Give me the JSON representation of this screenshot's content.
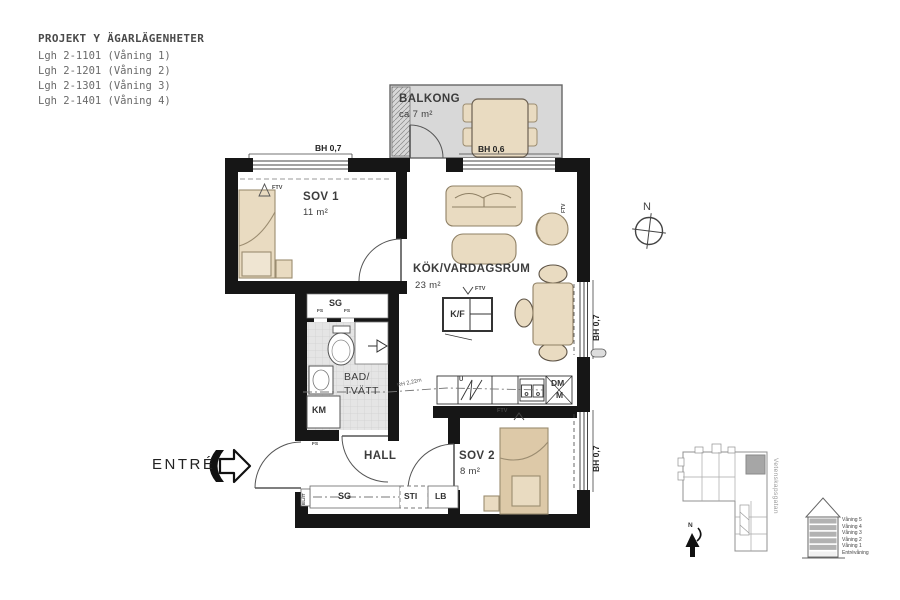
{
  "header": {
    "title": "PROJEKT Y ÄGARLÄGENHETER",
    "apartments": [
      "Lgh 2-1101 (Våning 1)",
      "Lgh 2-1201 (Våning 2)",
      "Lgh 2-1301 (Våning 3)",
      "Lgh 2-1401 (Våning 4)"
    ]
  },
  "plan": {
    "rooms": {
      "balkong": {
        "name": "BALKONG",
        "area": "ca 7 m²"
      },
      "sov1": {
        "name": "SOV 1",
        "area": "11 m²"
      },
      "kok": {
        "name": "KÖK/VARDAGSRUM",
        "area": "23 m²"
      },
      "bad": {
        "name_line1": "BAD/",
        "name_line2": "TVÄTT"
      },
      "hall": {
        "name": "HALL"
      },
      "sov2": {
        "name": "SOV 2",
        "area": "8 m²"
      }
    },
    "fixtures": {
      "sg": "SG",
      "km": "KM",
      "kf": "K/F",
      "u": "U",
      "dm": "DM",
      "m": "M",
      "sti": "STI",
      "lb": "LB"
    },
    "marks": {
      "ftv": "FTV",
      "fs": "FS",
      "elit": "EL/IT",
      "rh": "RH 2,22m"
    },
    "sill_heights": {
      "bh06": "BH 0,6",
      "bh07": "BH 0,7"
    },
    "entre": "ENTRÉ",
    "compass_n": "N"
  },
  "site_plan": {
    "street": "Vetenskapsgatan",
    "north": "N"
  },
  "elevation": {
    "floors": [
      "Våning 5",
      "Våning 4",
      "Våning 3",
      "Våning 2",
      "Våning 1",
      "Entrévåning"
    ]
  },
  "colors": {
    "wall": "#161616",
    "furniture": "#e9dbc1",
    "furniture_stroke": "#9b8c70",
    "balcony": "#d8d8d8",
    "tile": "#e5e5e5",
    "unit_highlight": "#a6a6a6",
    "text": "#3f3f3f"
  }
}
